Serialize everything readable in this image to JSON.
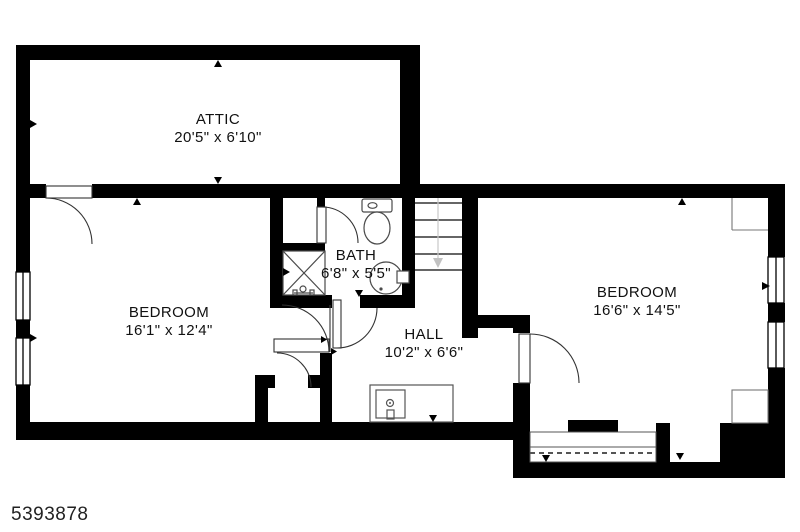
{
  "title": "Floor plan",
  "watermark": "5393878",
  "rooms": {
    "attic": {
      "name": "ATTIC",
      "dims": "20'5\" x 6'10\""
    },
    "bedroom_left": {
      "name": "BEDROOM",
      "dims": "16'1\" x 12'4\""
    },
    "bath": {
      "name": "BATH",
      "dims": "6'8\" x 5'5\""
    },
    "hall": {
      "name": "HALL",
      "dims": "10'2\" x 6'6\""
    },
    "bedroom_right": {
      "name": "BEDROOM",
      "dims": "16'6\" x 14'5\""
    }
  },
  "colors": {
    "wall": "#000000",
    "background": "#ffffff",
    "fixture_line": "#4a4a4a",
    "light_line": "#bbbbbb"
  }
}
